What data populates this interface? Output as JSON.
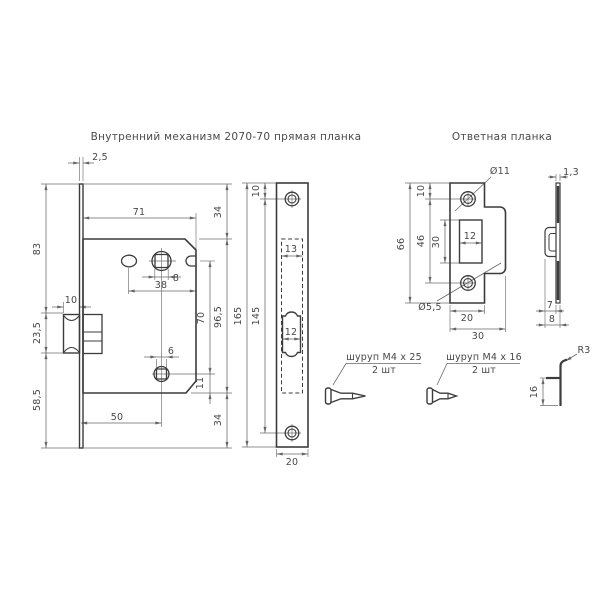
{
  "drawing": {
    "background": "#ffffff",
    "line_color": "#3c3c3c",
    "dim_color": "#666666"
  },
  "titles": {
    "mechanism": "Внутренний механизм 2070-70 прямая планка",
    "strike": "Ответная планка"
  },
  "mechanism_view": {
    "dims": {
      "faceplate_thickness": "2,5",
      "upper_section": "83",
      "latch_section": "23,5",
      "lower_section": "58,5",
      "latch_depth": "10",
      "body_width": "71",
      "top_offset": "34",
      "spindle_square": "8",
      "hole_spacing": "38",
      "spindle_to_fix": "70",
      "body_height": "96,5",
      "fix_square": "6",
      "fix_to_bottom": "11",
      "backset": "50",
      "bottom_offset": "34"
    }
  },
  "faceplate_view": {
    "dims": {
      "hole_offset": "10",
      "total_height": "165",
      "hole_spacing": "145",
      "cutout_width": "13",
      "latch_width": "12",
      "plate_width": "20"
    }
  },
  "strike_view": {
    "dims": {
      "hole_offset": "10",
      "total_height": "66",
      "hole_spacing": "46",
      "slot_height": "30",
      "slot_width": "12",
      "hole_dia_large": "Ø11",
      "hole_dia_small": "Ø5,5",
      "plate_width": "20",
      "total_width": "30"
    }
  },
  "side_view": {
    "dims": {
      "thickness": "1,3",
      "lip_depth": "7",
      "lip_total_depth": "8"
    }
  },
  "lip_detail": {
    "dims": {
      "radius": "R3",
      "lip_height": "16"
    }
  },
  "screws": {
    "long": {
      "label": "шуруп М4 x 25",
      "qty": "2 шт"
    },
    "short": {
      "label": "шуруп М4 x 16",
      "qty": "2 шт"
    }
  }
}
